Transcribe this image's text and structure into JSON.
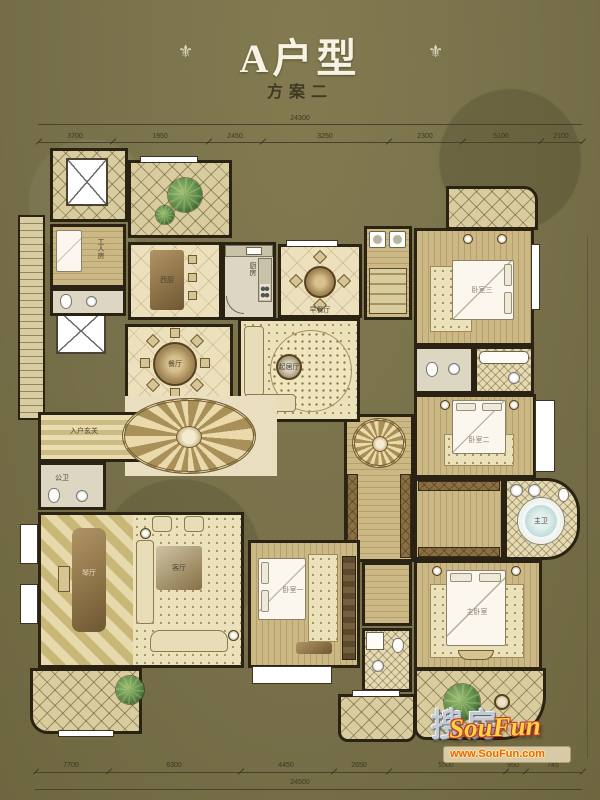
{
  "header": {
    "title": "A户型",
    "subtitle": "方案二",
    "ornament": "⚜"
  },
  "dimensions": {
    "top_total": "24300",
    "top_segments": [
      "3700",
      "1950",
      "2450",
      "3250",
      "2300",
      "5100",
      "2100"
    ],
    "bottom_segments": [
      "7700",
      "6300",
      "4450",
      "2650",
      "5500",
      "950",
      "745"
    ],
    "bottom_total": "24500"
  },
  "rooms": {
    "worker": "工人房",
    "west_kitchen": "西厨",
    "kitchen": "厨房",
    "breakfast": "早餐厅",
    "dining": "餐厅",
    "family": "起居厅",
    "foyer": "入户玄关",
    "guest_bath": "公卫",
    "piano": "琴厅",
    "living": "客厅",
    "bedroom1": "卧室一",
    "bedroom2": "卧室二",
    "bedroom3": "卧室三",
    "master": "主卧室",
    "master_bath": "主卫"
  },
  "watermark": {
    "cn": "搜房",
    "en": "SouFun",
    "url": "www.SouFun.com"
  },
  "colors": {
    "background_olive": "#77704a",
    "wall_dark": "#2a2212",
    "floor_cream": "#ece1bc",
    "watermark_gold": "#ffd24a",
    "watermark_red": "#c03a20",
    "watermark_orange": "#e8650d"
  }
}
